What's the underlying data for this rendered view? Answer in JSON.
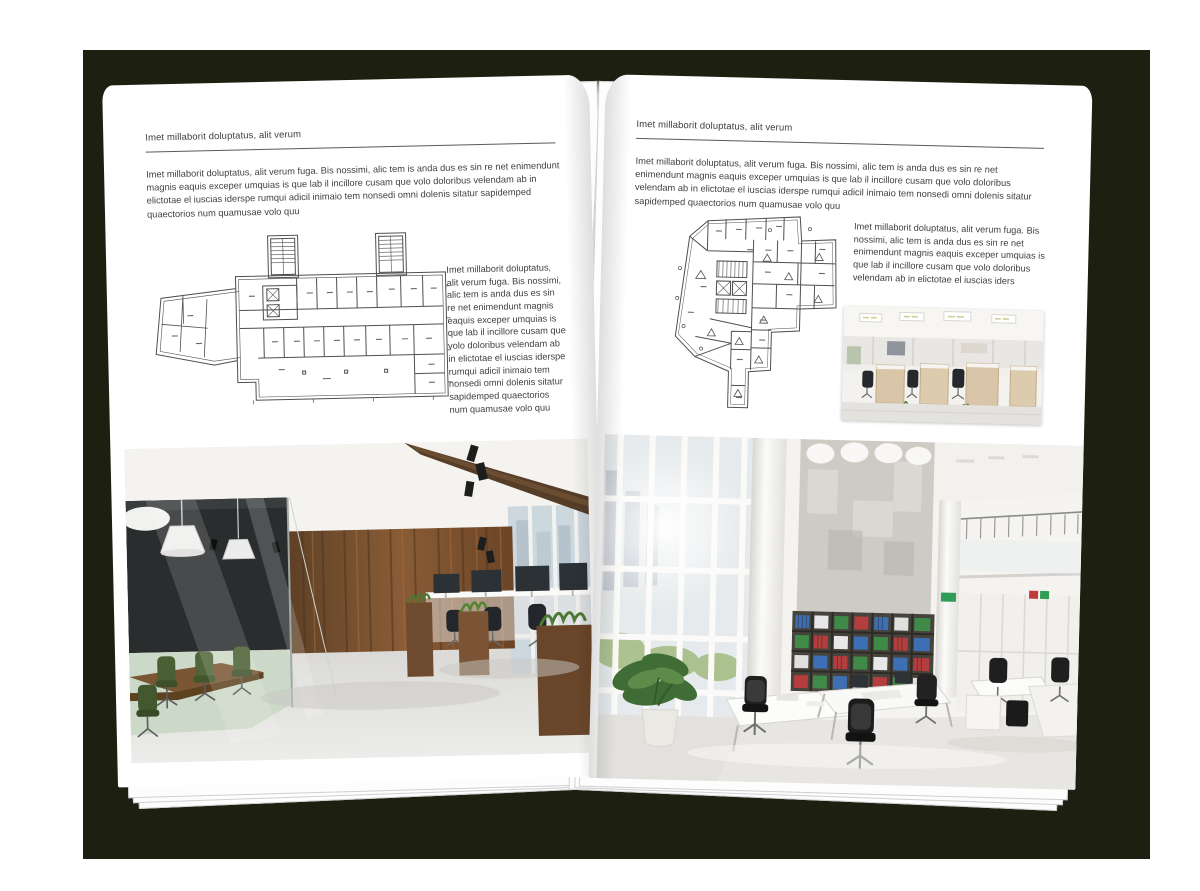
{
  "book": {
    "colors": {
      "backdrop": "#1d1f10",
      "page": "#ffffff",
      "text": "#3f3f3f",
      "rule": "#5a5a5a"
    },
    "left_page": {
      "header": "Imet millaborit doluptatus, alit verum",
      "intro": "Imet millaborit doluptatus, alit verum fuga. Bis nossimi, alic tem is anda dus es sin re net enimendunt magnis eaquis exceper umquias is que lab il incillore cusam que volo doloribus velendam ab in elictotae el iuscias iderspe rumqui adicil inimaio tem nonsedi omni dolenis sitatur sapidemped quaectorios num quamusae volo quu",
      "caption": "Imet millaborit doluptatus, alit verum fuga. Bis nossimi, alic tem is anda dus es sin re net enimendunt magnis eaquis exceper umquias is que lab il incillore cusam que volo doloribus velendam ab in elictotae el iuscias iderspe rumqui adicil inimaio tem nonsedi omni dolenis sitatur sapidemped quaectorios num quamusae volo quu",
      "figures": {
        "floor_plan": "wide-building-floor-plan-with-two-stair-towers",
        "photo": "office-interior-glass-meeting-room-wood-wall"
      }
    },
    "right_page": {
      "header": "Imet millaborit doluptatus, alit verum",
      "intro": "Imet millaborit doluptatus, alit verum fuga. Bis nossimi, alic tem is anda dus es sin re net enimendunt magnis eaquis exceper umquias is que lab il incillore cusam que volo doloribus velendam ab in elictotae el iuscias iderspe rumqui adicil inimaio tem nonsedi omni dolenis sitatur sapidemped quaectorios num quamusae volo quu",
      "caption": "Imet millaborit doluptatus, alit verum fuga. Bis nossimi, alic tem is anda dus es sin re net enimendunt magnis eaquis exceper umquias is que lab il incillore cusam que volo doloribus velendam ab in elictotae el iuscias iders",
      "figures": {
        "floor_plan": "irregular-building-floor-plan-with-core",
        "photo_small": "office-interior-workstations-ceiling-lights",
        "photo_large": "office-interior-atrium-bookshelves"
      }
    }
  }
}
